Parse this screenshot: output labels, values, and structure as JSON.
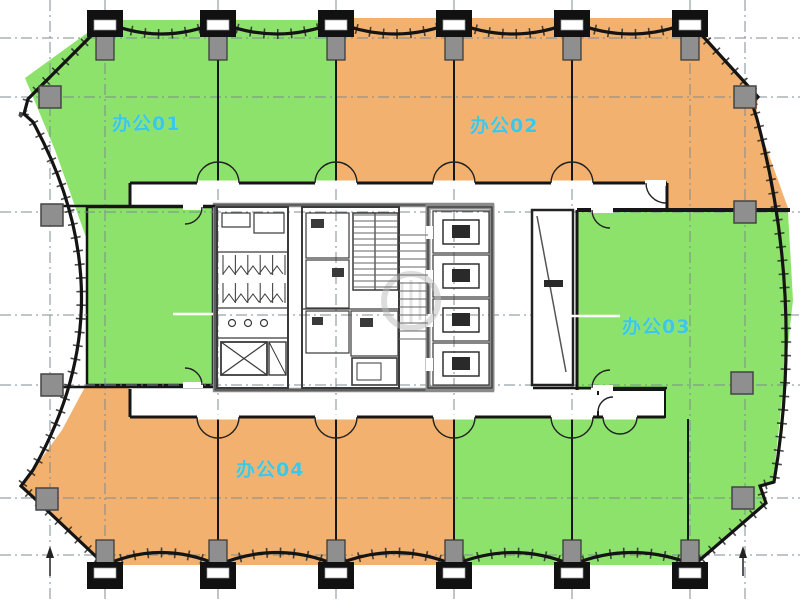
{
  "drawing": {
    "type": "floor-plan",
    "zones": [
      {
        "id": "office-01",
        "label": "办公01",
        "color": "#8DE26C"
      },
      {
        "id": "office-02",
        "label": "办公02",
        "color": "#F2B16E"
      },
      {
        "id": "office-03",
        "label": "办公03",
        "color": "#8DE26C"
      },
      {
        "id": "office-04",
        "label": "办公04",
        "color": "#F2B16E"
      }
    ],
    "colors": {
      "zone_green": "#8DE26C",
      "zone_orange": "#F2B16E",
      "label_cyan": "#3BC8E8",
      "wall": "#161616",
      "grid": "#7C8C94",
      "column_gray": "#8F8F8F",
      "core_gray": "#8a8a8a"
    },
    "grid": {
      "vertical_x": [
        50,
        105,
        218,
        336,
        454,
        572,
        690,
        745
      ],
      "horizontal_y": [
        38,
        97,
        212,
        385,
        498,
        555
      ],
      "mid_y": 315,
      "mid_y_segments": [
        [
          0,
          87
        ],
        [
          215,
          577
        ],
        [
          788,
          800
        ]
      ]
    },
    "columns": {
      "top_x": [
        105,
        218,
        336,
        454,
        572,
        690
      ],
      "bottom_x": [
        105,
        218,
        336,
        454,
        572,
        690
      ],
      "side": [
        [
          50,
          97
        ],
        [
          52,
          215
        ],
        [
          52,
          385
        ],
        [
          47,
          499
        ],
        [
          745,
          97
        ],
        [
          745,
          212
        ],
        [
          742,
          383
        ],
        [
          743,
          498
        ]
      ]
    },
    "partitions": {
      "top": {
        "xs": [
          218,
          336,
          454,
          572
        ],
        "y1": 60,
        "y2": 183
      },
      "bottom": {
        "xs": [
          218,
          336,
          454,
          572,
          688
        ],
        "y1": 419,
        "y2": 545
      }
    },
    "double_doors": [
      {
        "x": 218,
        "y": 183,
        "r": 21,
        "dir": "up"
      },
      {
        "x": 336,
        "y": 183,
        "r": 21,
        "dir": "up"
      },
      {
        "x": 454,
        "y": 183,
        "r": 21,
        "dir": "up"
      },
      {
        "x": 572,
        "y": 183,
        "r": 21,
        "dir": "up"
      },
      {
        "x": 218,
        "y": 417,
        "r": 21,
        "dir": "down"
      },
      {
        "x": 336,
        "y": 417,
        "r": 21,
        "dir": "down"
      },
      {
        "x": 454,
        "y": 417,
        "r": 21,
        "dir": "down"
      },
      {
        "x": 572,
        "y": 417,
        "r": 21,
        "dir": "down"
      },
      {
        "x": 620,
        "y": 417,
        "r": 17,
        "dir": "down"
      }
    ],
    "elevators": {
      "x": 433,
      "y0": 211,
      "w": 56,
      "h": 42,
      "gap": 44,
      "count": 4
    },
    "stairs": [
      {
        "x": 353,
        "y": 215,
        "w": 45,
        "h": 75,
        "step": 6
      },
      {
        "x": 399,
        "y": 235,
        "w": 29,
        "h": 104,
        "step": 8
      }
    ],
    "toilet_stalls": [
      {
        "x": 223,
        "y": 255,
        "w": 62,
        "h": 20,
        "n": 5
      },
      {
        "x": 223,
        "y": 283,
        "w": 62,
        "h": 20,
        "n": 5
      }
    ]
  }
}
